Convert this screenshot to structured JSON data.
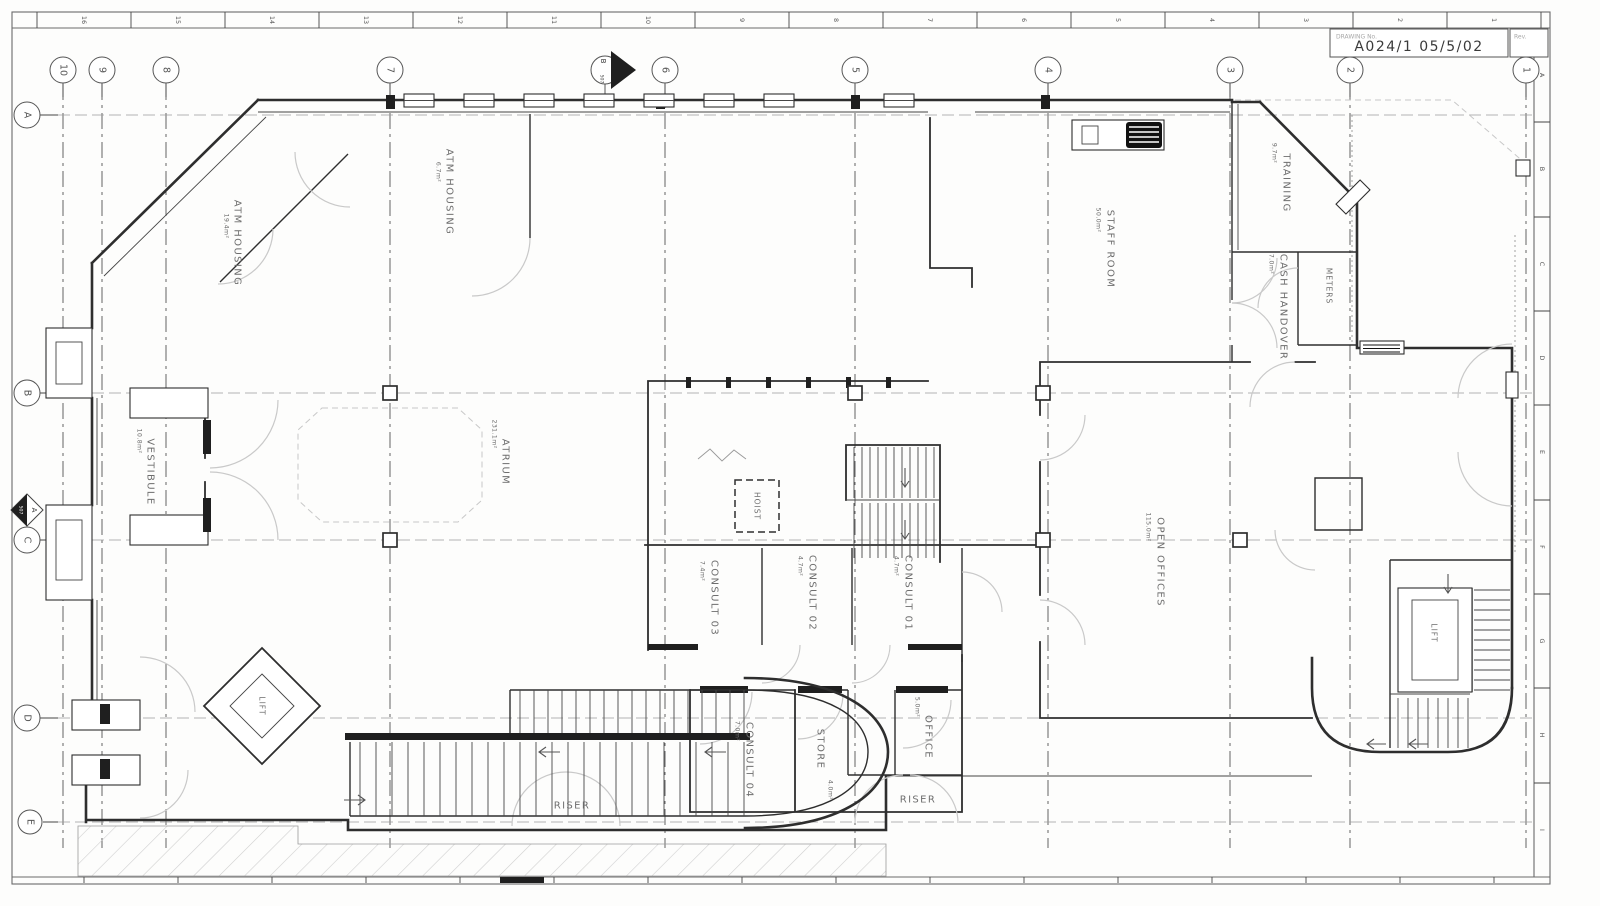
{
  "drawing": {
    "title_block": {
      "label": "DRAWING No.",
      "number": "A024/1 05/5/02",
      "rev_label": "Rev."
    },
    "top_ruler": [
      "16",
      "15",
      "14",
      "13",
      "12",
      "11",
      "10",
      "9",
      "8",
      "7",
      "6",
      "5",
      "4",
      "3",
      "2",
      "1"
    ],
    "right_ruler": [
      "A",
      "B",
      "C",
      "D",
      "E",
      "F",
      "G",
      "H",
      "I"
    ],
    "grid_columns": [
      "10",
      "9",
      "8",
      "7",
      "6",
      "5",
      "4",
      "3",
      "2",
      "1"
    ],
    "grid_rows": [
      "A",
      "B",
      "C",
      "D",
      "E"
    ],
    "section_markers": [
      {
        "label": "A",
        "sheet": "507"
      },
      {
        "label": "B",
        "sheet": "507"
      }
    ],
    "rooms": [
      {
        "name": "ATM HOUSING",
        "area": "19.4m²"
      },
      {
        "name": "ATM HOUSING",
        "area": "6.7m²"
      },
      {
        "name": "TRAINING",
        "area": "9.7m²"
      },
      {
        "name": "STAFF ROOM",
        "area": "50.0m²"
      },
      {
        "name": "CASH HANDOVER",
        "area": "7.0m²"
      },
      {
        "name": "METERS",
        "area": ""
      },
      {
        "name": "VESTIBULE",
        "area": "10.8m²"
      },
      {
        "name": "ATRIUM",
        "area": "231.1m²"
      },
      {
        "name": "HOIST",
        "area": ""
      },
      {
        "name": "CONSULT 03",
        "area": "7.4m²"
      },
      {
        "name": "CONSULT 02",
        "area": "4.7m²"
      },
      {
        "name": "CONSULT 01",
        "area": "4.7m²"
      },
      {
        "name": "OPEN OFFICES",
        "area": "115.0m²"
      },
      {
        "name": "LIFT",
        "area": ""
      },
      {
        "name": "CONSULT 04",
        "area": "7.0m²"
      },
      {
        "name": "STORE",
        "area": "4.0m²"
      },
      {
        "name": "OFFICE",
        "area": "5.0m²"
      },
      {
        "name": "RISER",
        "area": ""
      },
      {
        "name": "RISER",
        "area": ""
      },
      {
        "name": "LIFT",
        "area": ""
      }
    ],
    "colors": {
      "wall": "#2e2e2e",
      "door_arc": "#c9c9c9",
      "label": "#6e6e6e",
      "hatch": "#cfcfcf",
      "grid_row": "#9a9a9a",
      "grid_col": "#3c3c3c"
    }
  }
}
